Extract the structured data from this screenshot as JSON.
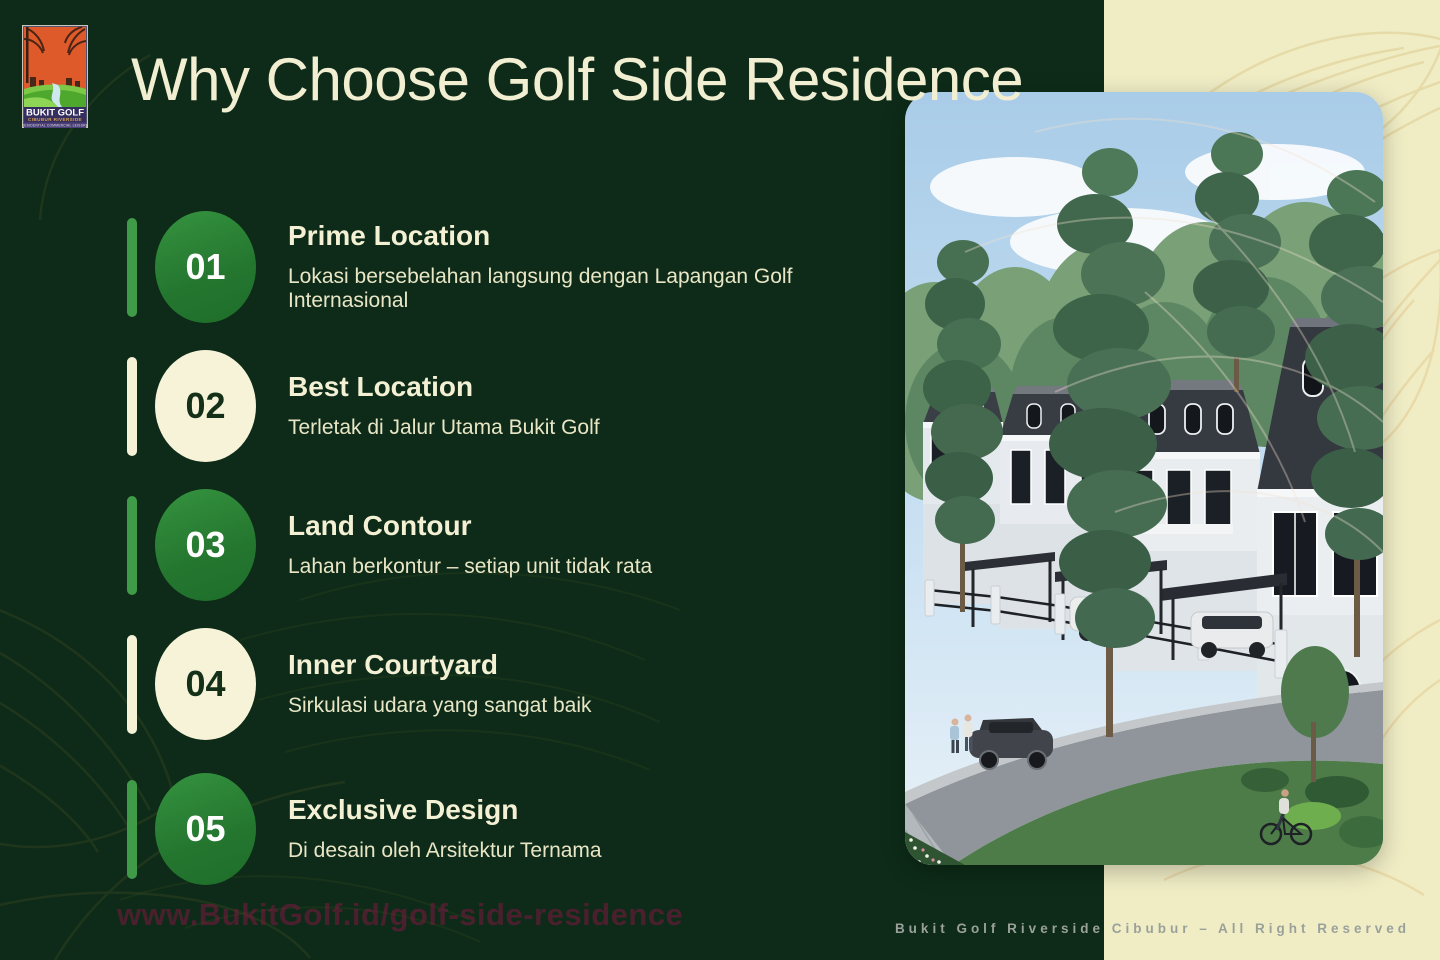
{
  "title": "Why Choose Golf Side Residence",
  "logo": {
    "name": "BUKIT GOLF",
    "subname": "CIBUBUR RIVERSIDE",
    "tagline": "RESIDENTIAL COMMERCIAL LEISURE"
  },
  "features": [
    {
      "num": "01",
      "heading": "Prime Location",
      "desc": "Lokasi bersebelahan langsung dengan Lapangan Golf Internasional",
      "style": "green"
    },
    {
      "num": "02",
      "heading": "Best Location",
      "desc": "Terletak di Jalur Utama Bukit Golf",
      "style": "cream"
    },
    {
      "num": "03",
      "heading": "Land Contour",
      "desc": "Lahan berkontur – setiap unit tidak rata",
      "style": "green"
    },
    {
      "num": "04",
      "heading": "Inner Courtyard",
      "desc": "Sirkulasi udara yang sangat baik",
      "style": "cream"
    },
    {
      "num": "05",
      "heading": "Exclusive Design",
      "desc": "Di desain oleh Arsitektur Ternama",
      "style": "green"
    }
  ],
  "photo": {
    "alt": "Row of two-story classic-style houses with dark mansard roofs, carports with cars, pine trees, street with pedestrians and a cyclist"
  },
  "footer": {
    "watermark": "www.BukitGolf.id/golf-side-residence",
    "copyright": "Bukit Golf Riverside Cibubur – All Right Reserved"
  },
  "colors": {
    "background_green": "#0d2b18",
    "panel_cream": "#f0edc5",
    "text_cream": "#f1eed2",
    "badge_green": "#2b7e35",
    "badge_cream": "#f6f3d8",
    "badge_number_dark": "#143018",
    "watermark_maroon": "#801842",
    "copyright_gray": "#9aa19b"
  }
}
